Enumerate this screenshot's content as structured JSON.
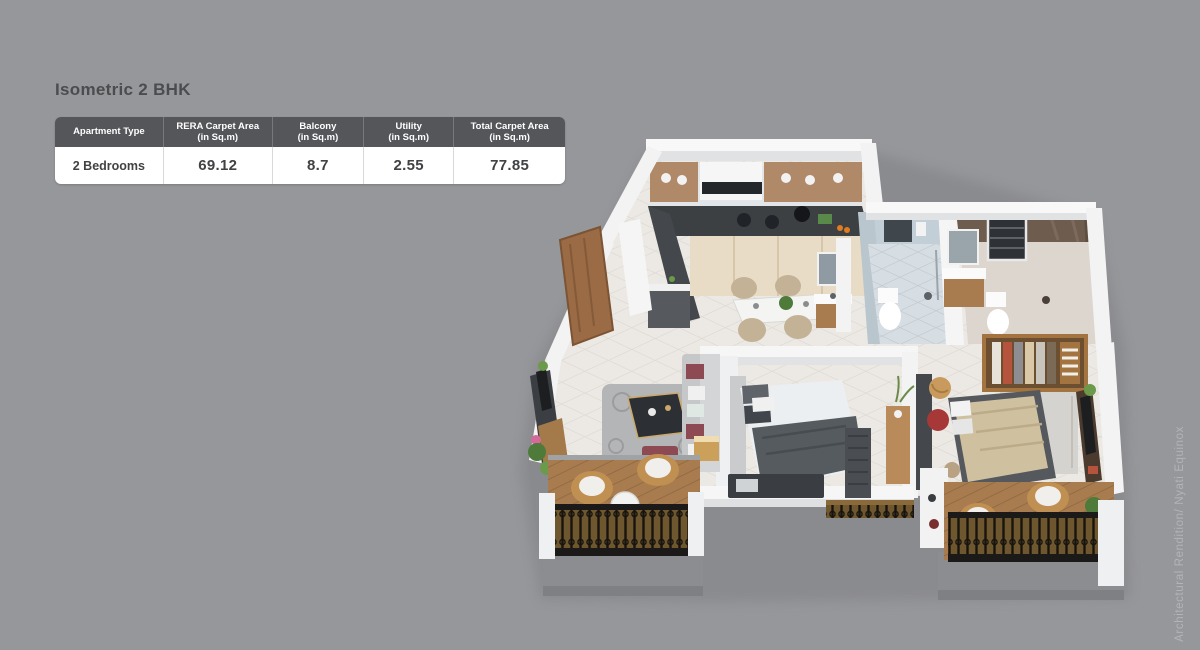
{
  "title": "Isometric 2 BHK",
  "watermark": "Architectural Rendition/ Nyati Equinox",
  "colors": {
    "background": "#96979a",
    "title_text": "#4b4c4e",
    "table_header_bg": "#55565a",
    "table_header_text": "#ffffff",
    "table_body_bg": "#ffffff",
    "table_body_text": "#414244",
    "watermark_text": "#b3b4b7"
  },
  "table": {
    "columns": [
      {
        "label": "Apartment Type",
        "sub": ""
      },
      {
        "label": "RERA Carpet Area",
        "sub": "(in Sq.m)"
      },
      {
        "label": "Balcony",
        "sub": "(in Sq.m)"
      },
      {
        "label": "Utility",
        "sub": "(in Sq.m)"
      },
      {
        "label": "Total Carpet Area",
        "sub": "(in Sq.m)"
      }
    ],
    "rows": [
      {
        "apartment_type": "2 Bedrooms",
        "rera_carpet_area": "69.12",
        "balcony": "8.7",
        "utility": "2.55",
        "total_carpet_area": "77.85"
      }
    ]
  }
}
